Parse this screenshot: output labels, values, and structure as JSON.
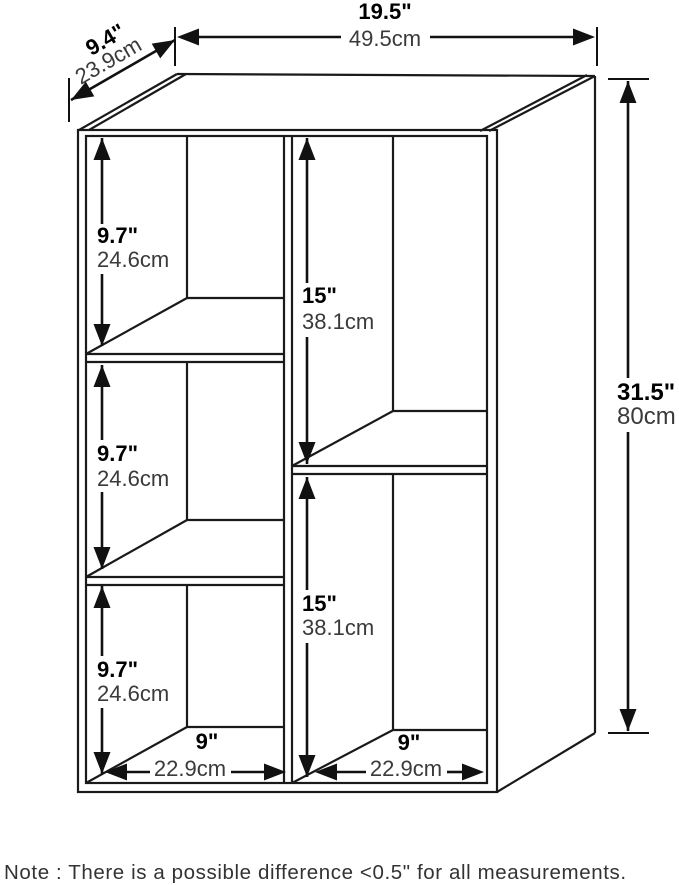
{
  "diagram": {
    "note": "Note : There is a possible difference <0.5\" for all measurements.",
    "dims": {
      "width": {
        "inches": "19.5\"",
        "cm": "49.5cm"
      },
      "depth": {
        "inches": "9.4\"",
        "cm": "23.9cm"
      },
      "height": {
        "inches": "31.5\"",
        "cm": "80cm"
      },
      "left_cubby_1": {
        "inches": "9.7\"",
        "cm": "24.6cm"
      },
      "left_cubby_2": {
        "inches": "9.7\"",
        "cm": "24.6cm"
      },
      "left_cubby_3": {
        "inches": "9.7\"",
        "cm": "24.6cm"
      },
      "right_cubby_1": {
        "inches": "15\"",
        "cm": "38.1cm"
      },
      "right_cubby_2": {
        "inches": "15\"",
        "cm": "38.1cm"
      },
      "left_cubby_width": {
        "inches": "9\"",
        "cm": "22.9cm"
      },
      "right_cubby_width": {
        "inches": "9\"",
        "cm": "22.9cm"
      }
    },
    "colors": {
      "line": "#1a1a1a",
      "bold_text": "#000000",
      "regular_text": "#3a3a3a",
      "background": "#ffffff"
    }
  }
}
